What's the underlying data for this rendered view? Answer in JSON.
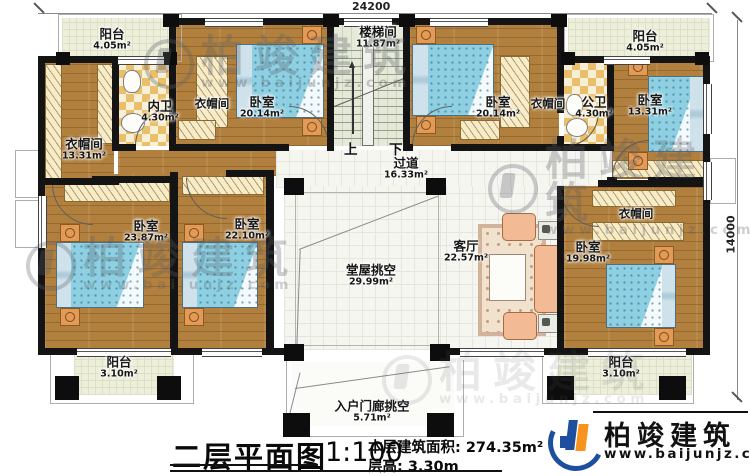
{
  "meta": {
    "plan_title": "二层平面图",
    "scale": "1:100",
    "area_line": "本层建筑面积: 274.35m²",
    "height_line": "层高: 3.30m"
  },
  "dimensions": {
    "top": "24200",
    "right": "14000"
  },
  "stairs": {
    "up": "上",
    "down": "下"
  },
  "watermark": {
    "brand": "柏竣建筑",
    "url": "www.baijunjz.com"
  },
  "logo": {
    "brand": "柏竣建筑",
    "url": "www.baijunjz.com"
  },
  "rooms": {
    "balcony_tl": {
      "name": "阳台",
      "area": "4.05m²"
    },
    "cloak_left": {
      "name": "衣帽间",
      "area": "13.31m²"
    },
    "bath_inner": {
      "name": "内卫",
      "area": "4.30m²"
    },
    "closet_tl": {
      "name": "衣帽间"
    },
    "bedroom_tl": {
      "name": "卧室",
      "area": "20.14m²"
    },
    "stairwell": {
      "name": "楼梯间",
      "area": "11.87m²"
    },
    "bedroom_tr": {
      "name": "卧室",
      "area": "20.14m²"
    },
    "closet_tr": {
      "name": "衣帽间"
    },
    "bath_public": {
      "name": "公卫",
      "area": "4.30m²"
    },
    "bedroom_r1": {
      "name": "卧室",
      "area": "13.31m²"
    },
    "balcony_tr": {
      "name": "阳台",
      "area": "4.05m²"
    },
    "corridor": {
      "name": "过道",
      "area": "16.33m²"
    },
    "bedroom_ml1": {
      "name": "卧室",
      "area": "23.87m²"
    },
    "bedroom_ml2": {
      "name": "卧室",
      "area": "22.10m²"
    },
    "hall_void": {
      "name": "堂屋挑空",
      "area": "29.99m²"
    },
    "living": {
      "name": "客厅",
      "area": "22.57m²"
    },
    "closet_right": {
      "name": "衣帽间"
    },
    "bedroom_r2": {
      "name": "卧室",
      "area": "19.98m²"
    },
    "balcony_bl": {
      "name": "阳台",
      "area": "3.10m²"
    },
    "porch_void": {
      "name": "入户门廊挑空",
      "area": "5.71m²"
    },
    "balcony_br": {
      "name": "阳台",
      "area": "3.10m²"
    }
  }
}
